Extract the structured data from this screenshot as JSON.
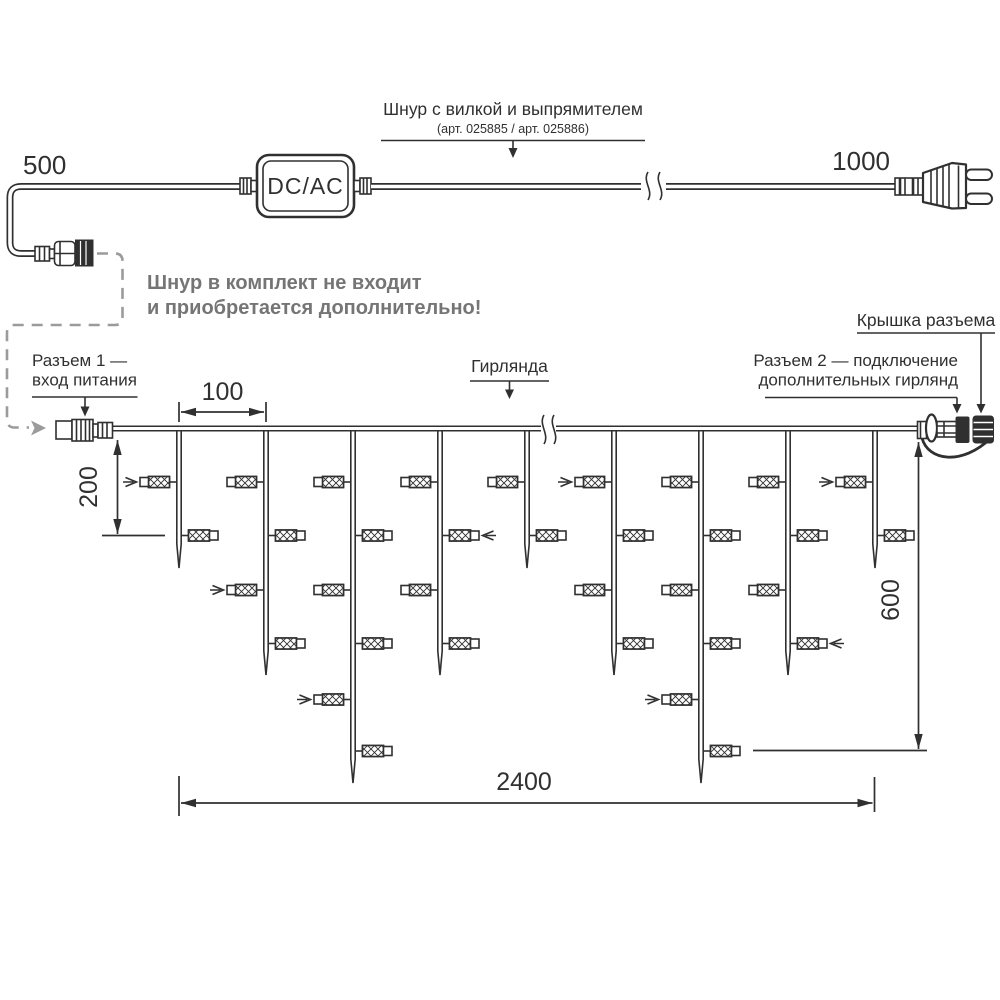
{
  "diagram": {
    "cord": {
      "len_left": "500",
      "len_right": "1000",
      "converter": "DC/AC",
      "title": "Шнур с вилкой и выпрямителем",
      "subtitle": "(арт. 025885 / арт. 025886)",
      "note1": "Шнур в комплект не входит",
      "note2": "и приобретается дополнительно!"
    },
    "garland": {
      "label": "Гирлянда",
      "conn1_line1": "Разъем 1 —",
      "conn1_line2": "вход питания",
      "conn2_line1": "Разъем 2 — подключение",
      "conn2_line2": "дополнительных гирлянд",
      "cap_label": "Крышка разъема",
      "dim_spacing": "100",
      "dim_first_drop": "200",
      "dim_height": "600",
      "dim_length": "2400"
    },
    "colors": {
      "line": "#303030",
      "gray": "#9b9b9b",
      "note_text": "#757575",
      "background": "#ffffff"
    },
    "layout": {
      "wire_y": 428.5,
      "bulb_rows": [
        482,
        535.5,
        590,
        643.5,
        699.5,
        751
      ],
      "drops": [
        {
          "x": 179,
          "tip": 568,
          "bulbs": [
            {
              "row": 0,
              "side": "L",
              "arrow": true
            },
            {
              "row": 1,
              "side": "R"
            }
          ]
        },
        {
          "x": 266,
          "tip": 675,
          "bulbs": [
            {
              "row": 0,
              "side": "L"
            },
            {
              "row": 1,
              "side": "R"
            },
            {
              "row": 2,
              "side": "L",
              "arrow": true
            },
            {
              "row": 3,
              "side": "R"
            }
          ]
        },
        {
          "x": 353,
          "tip": 783,
          "bulbs": [
            {
              "row": 0,
              "side": "L"
            },
            {
              "row": 1,
              "side": "R"
            },
            {
              "row": 2,
              "side": "L"
            },
            {
              "row": 3,
              "side": "R"
            },
            {
              "row": 4,
              "side": "L",
              "arrow": true
            },
            {
              "row": 5,
              "side": "R"
            }
          ]
        },
        {
          "x": 440,
          "tip": 675,
          "bulbs": [
            {
              "row": 0,
              "side": "L"
            },
            {
              "row": 1,
              "side": "R",
              "arrow": true
            },
            {
              "row": 2,
              "side": "L"
            },
            {
              "row": 3,
              "side": "R"
            }
          ]
        },
        {
          "x": 527,
          "tip": 568,
          "bulbs": [
            {
              "row": 0,
              "side": "L"
            },
            {
              "row": 1,
              "side": "R"
            }
          ]
        },
        {
          "x": 614,
          "tip": 675,
          "bulbs": [
            {
              "row": 0,
              "side": "L",
              "arrow": true
            },
            {
              "row": 1,
              "side": "R"
            },
            {
              "row": 2,
              "side": "L"
            },
            {
              "row": 3,
              "side": "R"
            }
          ]
        },
        {
          "x": 701,
          "tip": 783,
          "bulbs": [
            {
              "row": 0,
              "side": "L"
            },
            {
              "row": 1,
              "side": "R"
            },
            {
              "row": 2,
              "side": "L"
            },
            {
              "row": 3,
              "side": "R"
            },
            {
              "row": 4,
              "side": "L",
              "arrow": true
            },
            {
              "row": 5,
              "side": "R"
            }
          ]
        },
        {
          "x": 788,
          "tip": 675,
          "bulbs": [
            {
              "row": 0,
              "side": "L"
            },
            {
              "row": 1,
              "side": "R"
            },
            {
              "row": 2,
              "side": "L"
            },
            {
              "row": 3,
              "side": "R",
              "arrow": true
            }
          ]
        },
        {
          "x": 875,
          "tip": 568,
          "bulbs": [
            {
              "row": 0,
              "side": "L",
              "arrow": true
            },
            {
              "row": 1,
              "side": "R"
            }
          ]
        }
      ]
    }
  }
}
